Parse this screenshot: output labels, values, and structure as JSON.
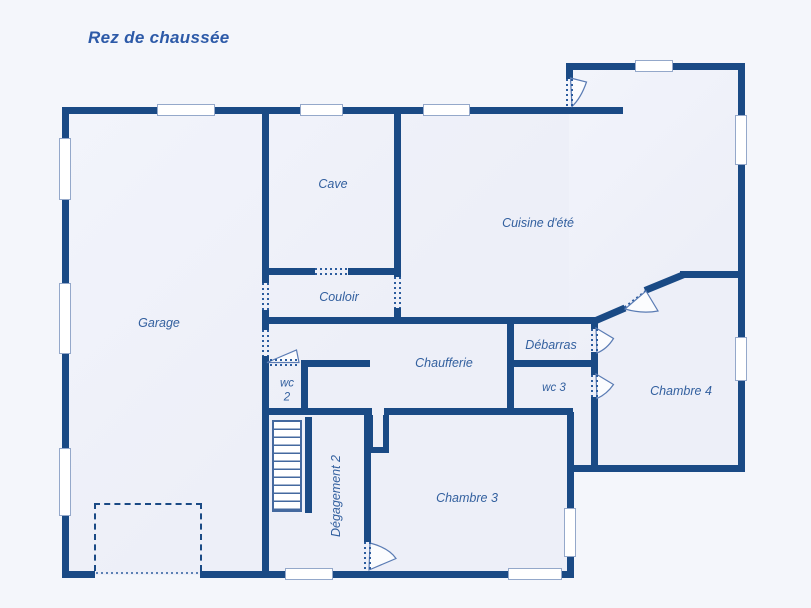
{
  "title": "Rez de chaussée",
  "rooms": {
    "garage": "Garage",
    "cave": "Cave",
    "couloir": "Couloir",
    "cuisine": "Cuisine d'été",
    "chaufferie": "Chaufferie",
    "debarras": "Débarras",
    "wc2_line1": "wc",
    "wc2_line2": "2",
    "wc3": "wc 3",
    "chambre4": "Chambre 4",
    "chambre3": "Chambre 3",
    "degagement2": "Dégagement 2"
  },
  "colors": {
    "wall": "#1a4a85",
    "room_label": "#33609f",
    "title_text": "#2d5aa8",
    "window_border": "#94a8ca",
    "interior_fill": "#edeff8",
    "page_background": "#f4f6fb",
    "stair_outline": "#44699f",
    "door_leaf_outline": "#5b7cb4",
    "dotted_opening": "#2c5c9e"
  }
}
